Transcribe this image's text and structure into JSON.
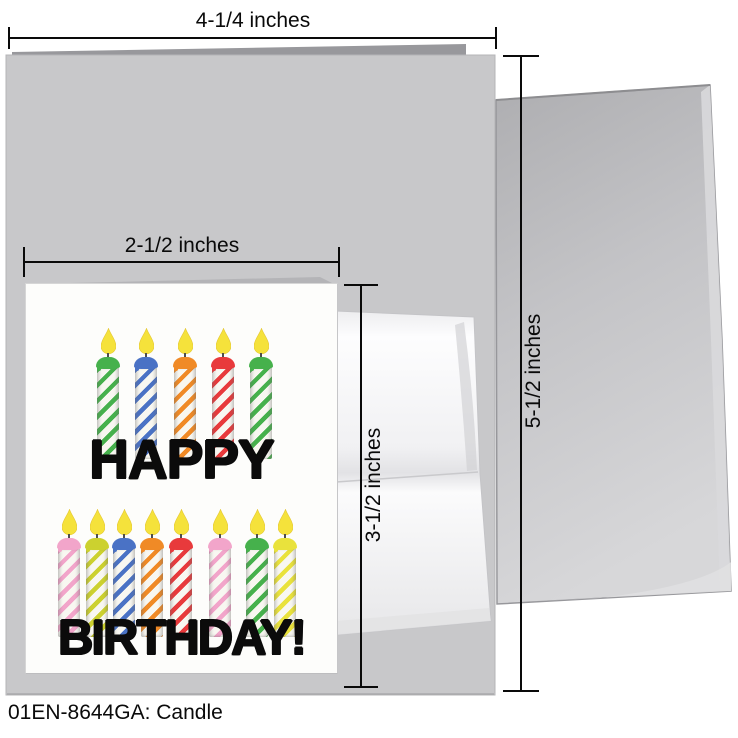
{
  "footer": {
    "code_label": "01EN-8644GA: Candle"
  },
  "dimensions": {
    "large_card_width_label": "4-1/4 inches",
    "large_card_height_label": "5-1/2 inches",
    "small_card_width_label": "2-1/2 inches",
    "small_card_height_label": "3-1/2 inches"
  },
  "card": {
    "word_top": "HAPPY",
    "word_bottom": "BIRTHDAY!"
  },
  "art": {
    "flame_color": "#f5e23b",
    "flame_edge_color": "#e3c531",
    "wick_color": "#4d4d4d",
    "wax_color": "#f8f7f1",
    "palette": {
      "green": "#46b14c",
      "blue": "#4a72c5",
      "orange": "#f08a26",
      "red": "#e83a3c",
      "pink": "#f2a5ca",
      "chartreuse": "#ccd12f",
      "yellow": "#e9e23c"
    },
    "rows": [
      {
        "name": "top-row",
        "flame_top": 44,
        "body_height": 92,
        "candles": [
          {
            "x": 82,
            "color": "green"
          },
          {
            "x": 120,
            "color": "blue"
          },
          {
            "x": 159,
            "color": "orange"
          },
          {
            "x": 197,
            "color": "red"
          },
          {
            "x": 235,
            "color": "green"
          }
        ]
      },
      {
        "name": "bottom-row",
        "flame_top": 225,
        "body_height": 89,
        "candles": [
          {
            "x": 43,
            "color": "pink"
          },
          {
            "x": 71,
            "color": "chartreuse"
          },
          {
            "x": 98,
            "color": "blue"
          },
          {
            "x": 126,
            "color": "orange"
          },
          {
            "x": 155,
            "color": "red"
          },
          {
            "x": 194,
            "color": "pink"
          },
          {
            "x": 231,
            "color": "green"
          },
          {
            "x": 259,
            "color": "yellow"
          }
        ]
      }
    ]
  },
  "scene": {
    "large_card_color": "#c8c8ca",
    "large_card_flap_color": "#98989c",
    "small_card_flap_color": "#b4b4b7",
    "annotation_color": "#0a0a0a"
  }
}
